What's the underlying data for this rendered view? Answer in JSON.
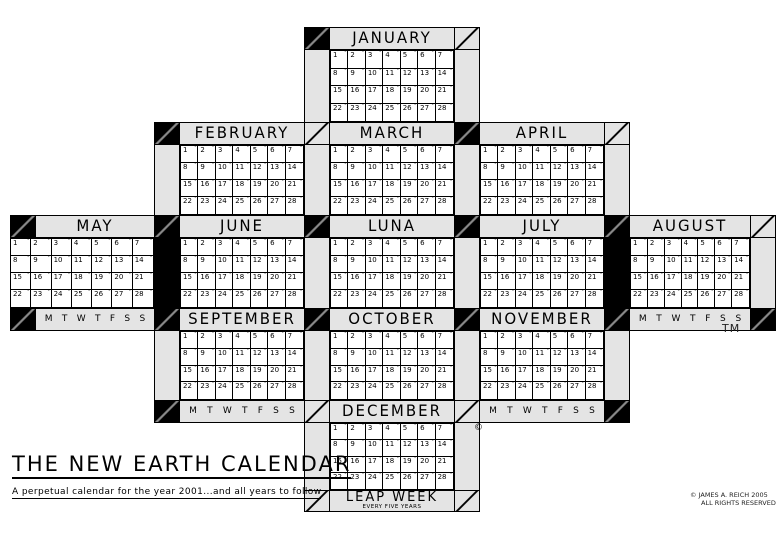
{
  "page": {
    "title": "THE NEW EARTH CALENDAR",
    "subtitle": "A perpetual calendar for the year 2001...and all years to follow",
    "trademark": "TM",
    "december_copyright_mark": "©",
    "copyright_line1": "© JAMES A. REICH 2005",
    "copyright_line2": "ALL RIGHTS RESERVED"
  },
  "weekdays": [
    "M",
    "T",
    "W",
    "T",
    "F",
    "S",
    "S"
  ],
  "day_numbers": [
    1,
    2,
    3,
    4,
    5,
    6,
    7,
    8,
    9,
    10,
    11,
    12,
    13,
    14,
    15,
    16,
    17,
    18,
    19,
    20,
    21,
    22,
    23,
    24,
    25,
    26,
    27,
    28
  ],
  "leap_week": {
    "label": "LEAP WEEK",
    "sublabel": "EVERY FIVE YEARS",
    "corner_left": "diag",
    "corner_right": "diag"
  },
  "months": [
    {
      "name": "JANUARY",
      "band": 1,
      "col": "C",
      "header_left": "black",
      "header_right": "diag",
      "strip_left": "gray",
      "strip_right": "gray",
      "footer": false
    },
    {
      "name": "FEBRUARY",
      "band": 2,
      "col": "B",
      "header_left": "black",
      "header_right": "diag",
      "strip_left": "gray",
      "strip_right": "gray",
      "footer": false
    },
    {
      "name": "MARCH",
      "band": 2,
      "col": "C",
      "header_left": "diag",
      "header_right": "black",
      "strip_left": "gray",
      "strip_right": "gray",
      "footer": false
    },
    {
      "name": "APRIL",
      "band": 2,
      "col": "D",
      "header_left": "black",
      "header_right": "diag",
      "strip_left": "gray",
      "strip_right": "gray",
      "footer": false
    },
    {
      "name": "MAY",
      "band": 3,
      "col": "A",
      "header_left": "black",
      "header_right": "black",
      "strip_left": "none",
      "strip_right": "black",
      "footer": true,
      "footer_left": "black",
      "footer_right": "black"
    },
    {
      "name": "JUNE",
      "band": 3,
      "col": "B",
      "header_left": "black",
      "header_right": "black",
      "strip_left": "black",
      "strip_right": "gray",
      "footer": false
    },
    {
      "name": "LUNA",
      "band": 3,
      "col": "C",
      "header_left": "black",
      "header_right": "black",
      "strip_left": "gray",
      "strip_right": "gray",
      "footer": false
    },
    {
      "name": "JULY",
      "band": 3,
      "col": "D",
      "header_left": "black",
      "header_right": "black",
      "strip_left": "gray",
      "strip_right": "black",
      "footer": false
    },
    {
      "name": "AUGUST",
      "band": 3,
      "col": "E",
      "header_left": "black",
      "header_right": "diag",
      "strip_left": "black",
      "strip_right": "gray",
      "footer": true,
      "footer_left": "black",
      "footer_right": "black"
    },
    {
      "name": "SEPTEMBER",
      "band": 4,
      "col": "B",
      "header_left": "black",
      "header_right": "black",
      "strip_left": "gray",
      "strip_right": "gray",
      "footer": true,
      "footer_left": "black",
      "footer_right": "diag"
    },
    {
      "name": "OCTOBER",
      "band": 4,
      "col": "C",
      "header_left": "black",
      "header_right": "black",
      "strip_left": "gray",
      "strip_right": "gray",
      "footer": false
    },
    {
      "name": "NOVEMBER",
      "band": 4,
      "col": "D",
      "header_left": "black",
      "header_right": "black",
      "strip_left": "gray",
      "strip_right": "gray",
      "footer": true,
      "footer_left": "diag",
      "footer_right": "black"
    },
    {
      "name": "DECEMBER",
      "band": 5,
      "col": "C",
      "header_left": "diag",
      "header_right": "diag",
      "strip_left": "gray",
      "strip_right": "gray",
      "footer": false
    }
  ]
}
